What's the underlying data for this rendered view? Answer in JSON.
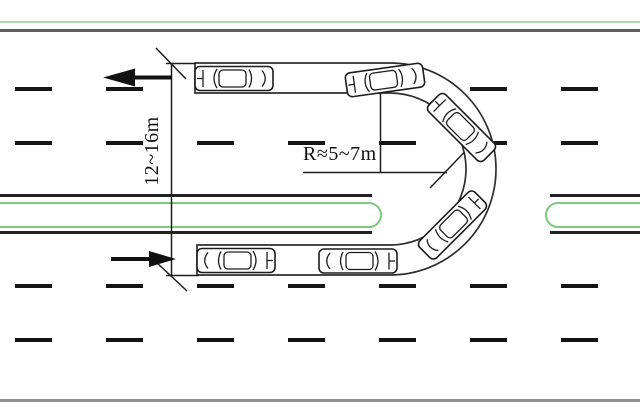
{
  "figure": {
    "type": "road-u-turn-diagram",
    "description": "Top view schematic of a vehicle performing a U-turn through a median opening on a divided multi-lane road",
    "labels": {
      "turn_width": "12~16m",
      "turn_radius": "R≈5~7m"
    },
    "arrows": [
      {
        "name": "westbound-direction-arrow",
        "direction": "left"
      },
      {
        "name": "eastbound-direction-arrow",
        "direction": "right"
      }
    ],
    "road": {
      "lane_marking_style": "dashed",
      "dash_rows": 4,
      "median": "green outlined strips with U-turn opening"
    },
    "cars": [
      {
        "id": "car-top-straight",
        "heading": "west"
      },
      {
        "id": "car-top-entering-lane",
        "heading": "west-tilted"
      },
      {
        "id": "car-curve-upper",
        "heading": "north-west"
      },
      {
        "id": "car-curve-lower",
        "heading": "north-east"
      },
      {
        "id": "car-bottom-mid",
        "heading": "east"
      },
      {
        "id": "car-bottom-start",
        "heading": "east"
      }
    ],
    "colors": {
      "median_green": "#7dc97d",
      "edge_green": "#aed8ae",
      "line_dark": "#1d1d1d",
      "road_edge_top": "#5f5f5f",
      "road_edge_bottom": "#8f8f8f"
    }
  }
}
